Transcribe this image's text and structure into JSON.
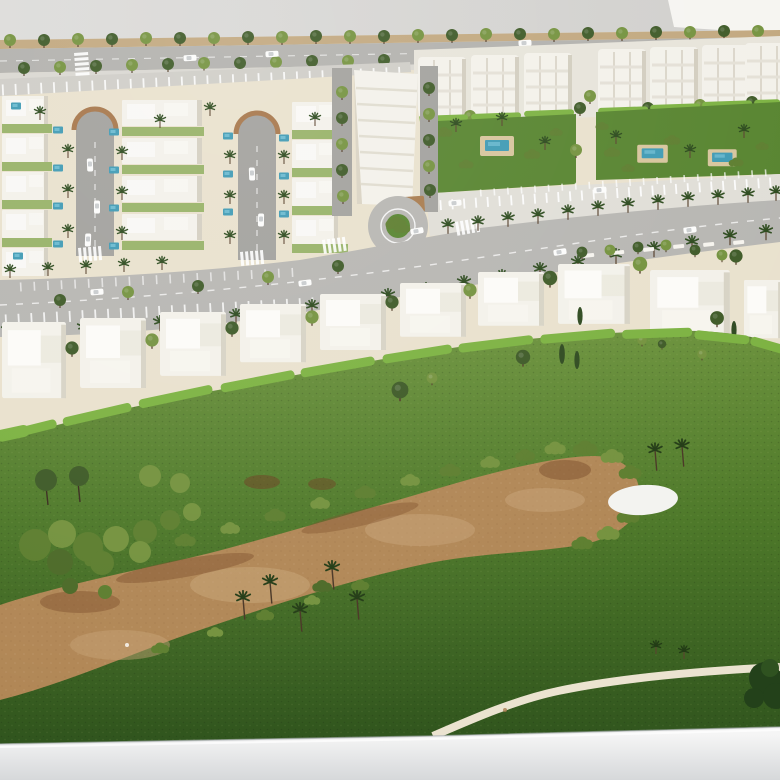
{
  "meta": {
    "description": "Aerial photograph of a white architectural scale model of a resort masterplan: rows of townhouses around two cul-de-sac streets, white apartment blocks with garden pools, a palm-lined curving avenue, a row of detached villas behind hedges, and a golf course with a large sandy waste area, a white green, palm trees and a cart path, all displayed on a white base table against a grey wall."
  },
  "scene": {
    "background": "grey wall with bright white panel in top-right corner",
    "upper_left": "townhouse blocks around two cul-de-sac streets with small blue pools and palm trees",
    "upper_right": "four-storey apartment blocks with communal gardens and swimming pools",
    "middle": "curving palm-lined avenue with roundabout, parking bays and white cars",
    "villa_row": "curved row of white flat-roofed villas with trees and bright hedges",
    "lower": "golf course with brown waste bunker, shrubs, palms, white green and cart path",
    "bottom": "white display base with curving cart path exiting right"
  },
  "colors": {
    "wall_left": "#dddcda",
    "wall_right": "#cfcecb",
    "panel_white": "#f6f5f1",
    "plot_cream": "#e9e1cd",
    "boulevard_tan": "#c2a87f",
    "boulevard_road": "#b2b1ad",
    "street_grey": "#a2a19d",
    "avenue_grey": "#b7b6b2",
    "promenade_white": "#e0ded7",
    "apartment_ground": "#e7e4da",
    "building_white": "#f3f1ea",
    "building_shadow": "#d4cfc1",
    "rim_tan": "#a6764a",
    "dirt_brown": "#a87c4e",
    "hedge_green": "#7cb241",
    "garden_green": "#57842f",
    "lawn_strip": "#8fae5c",
    "grass_top": "#69903a",
    "grass_mid": "#4d7829",
    "grass_bottom": "#2f531d",
    "tree_dark": "#3e5a27",
    "tree_olive": "#74923e",
    "bush_green": "#5d7e2f",
    "palm_green": "#2c4a1d",
    "cypress_green": "#2f4a20",
    "trunk_brown": "#55402c",
    "sand_main": "#b18756",
    "sand_light": "#c7a477",
    "sand_dark": "#7c4e2a",
    "pool_water": "#3f9ab4",
    "pool_light": "#7cc6da",
    "pool_deck": "#d7c59d",
    "marking_white": "#ffffff",
    "car_white": "#fcfcfb",
    "base_top": "#f5f5f5",
    "base_bottom": "#d6d8da",
    "base_shadow": "#a9adb0",
    "path_cream": "#ebe3d0",
    "green_white": "#f3f3f0"
  }
}
